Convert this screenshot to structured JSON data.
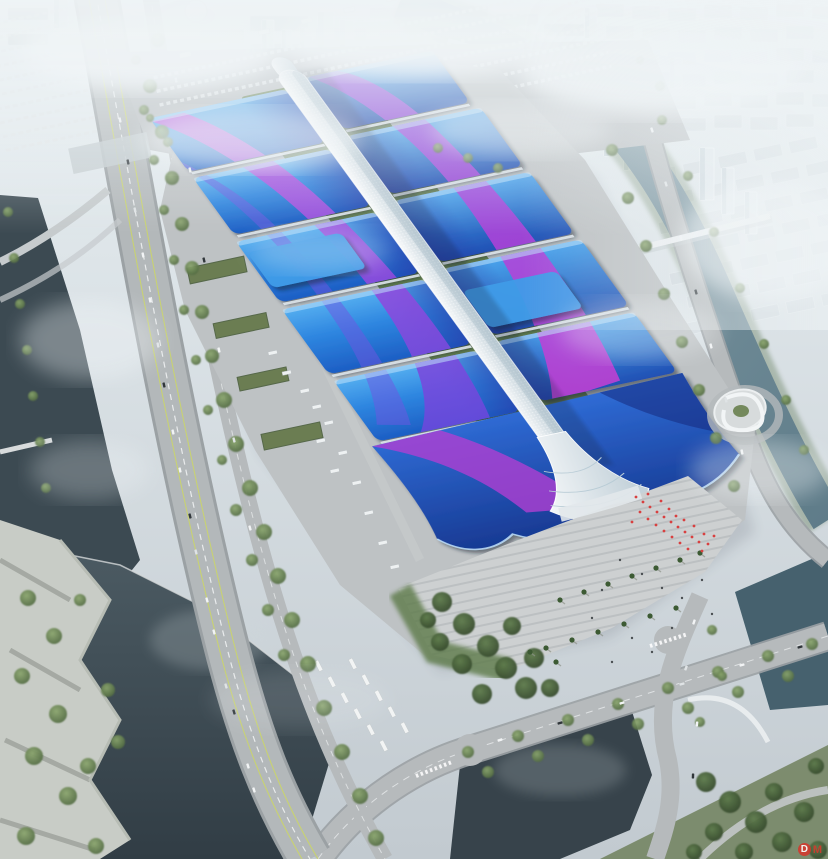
{
  "palette": {
    "haze_white": "#eef3f5",
    "sky_top": "#e9f0f3",
    "ground_gray": "#c2cad0",
    "apron_gray": "#bec2c4",
    "road_gray": "#b6babc",
    "roof_blue_light": "#56aff0",
    "roof_blue": "#2e86e0",
    "roof_blue_deep": "#1d5ec4",
    "roof_navy": "#16368e",
    "ribbon_magenta": "#c44fe0",
    "ribbon_purple": "#6b48dc",
    "spine_white": "#f4f8fa",
    "spine_shade": "#c4d2da",
    "green_roof": "#5f7a48",
    "tree_green": "#5d7a4a",
    "water_dark": "#39454d",
    "water_river": "#6d8894",
    "people_red": "#d84040",
    "watermark_red": "#d23a2e"
  },
  "watermark": {
    "logo_letter": "D",
    "text": "M"
  }
}
